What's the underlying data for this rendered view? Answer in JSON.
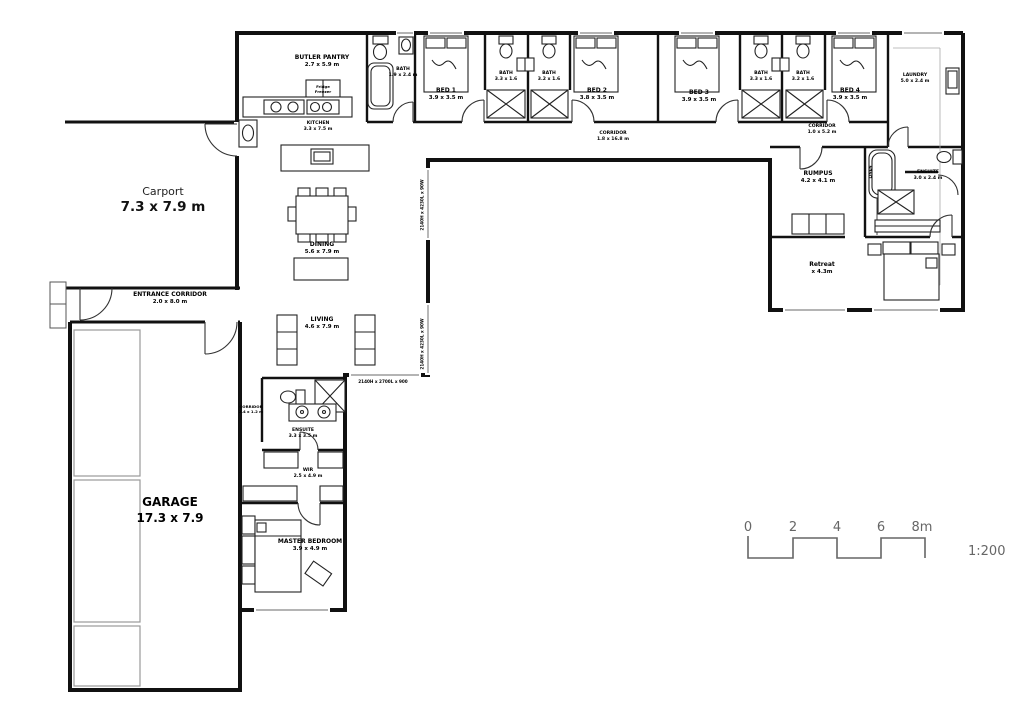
{
  "scale": {
    "ticks": [
      "0",
      "2",
      "4",
      "6",
      "8m"
    ],
    "ratio": "1:200"
  },
  "rooms": {
    "butler_pantry": {
      "name": "BUTLER PANTRY",
      "dims": "2.7 x 5.9 m"
    },
    "fridge": {
      "name": "Fridge",
      "dims": "Freezer"
    },
    "bath_top": {
      "name": "BATH",
      "dims": "1.9 x 2.4 m"
    },
    "bed1": {
      "name": "BED 1",
      "dims": "3.9 x 3.5 m"
    },
    "bath1": {
      "name": "BATH",
      "dims": "3.3 x 1.6"
    },
    "bath2": {
      "name": "BATH",
      "dims": "3.2 x 1.6"
    },
    "bed2": {
      "name": "BED 2",
      "dims": "3.8 x 3.5 m"
    },
    "kitchen": {
      "name": "KITCHEN",
      "dims": "3.3 x 7.5 m"
    },
    "corridor_main": {
      "name": "CORRIDOR",
      "dims": "1.8 x 16.8 m"
    },
    "bed3": {
      "name": "BED 3",
      "dims": "3.9 x 3.5 m"
    },
    "bath3": {
      "name": "BATH",
      "dims": "3.3 x 1.6"
    },
    "bath4": {
      "name": "BATH",
      "dims": "3.2 x 1.6"
    },
    "bed4": {
      "name": "BED 4",
      "dims": "3.9 x 3.5 m"
    },
    "laundry": {
      "name": "LAUNDRY",
      "dims": "5.0 x 2.4 m"
    },
    "corridor_right": {
      "name": "CORRIDOR",
      "dims": "1.0 x 5.2 m"
    },
    "rumpus": {
      "name": "RUMPUS",
      "dims": "4.2 x 4.1 m"
    },
    "linen": {
      "name": "LINEN",
      "dims": ""
    },
    "ensuite_right": {
      "name": "ENSUITE",
      "dims": "3.0 x 2.4 m"
    },
    "retreat": {
      "name": "Retreat",
      "dims": "x 4.3m"
    },
    "dining": {
      "name": "DINING",
      "dims": "5.6 x 7.9 m"
    },
    "living": {
      "name": "LIVING",
      "dims": "4.6 x 7.9 m"
    },
    "carport": {
      "name": "Carport",
      "dims": "7.3 x 7.9 m"
    },
    "entrance_corridor": {
      "name": "ENTRANCE CORRIDOR",
      "dims": "2.0 x 8.0 m"
    },
    "garage": {
      "name": "GARAGE",
      "dims": "17.3 x 7.9"
    },
    "ensuite_master": {
      "name": "ENSUITE",
      "dims": "3.3 x 3.5 m"
    },
    "corridor_master": {
      "name": "CORRIDOR",
      "dims": "2.4 x 1.2 m"
    },
    "wir": {
      "name": "WIR",
      "dims": "2.5 x 4.9 m"
    },
    "master_bedroom": {
      "name": "MASTER BEDROOM",
      "dims": "3.9 x 4.9 m"
    }
  },
  "annotations": {
    "window_spec_living_top": "2140H x 4230L x 90W",
    "window_spec_living_bottom": "2140H x 4230L x 90W",
    "window_spec_master": "2140H x 2700L x 900"
  }
}
